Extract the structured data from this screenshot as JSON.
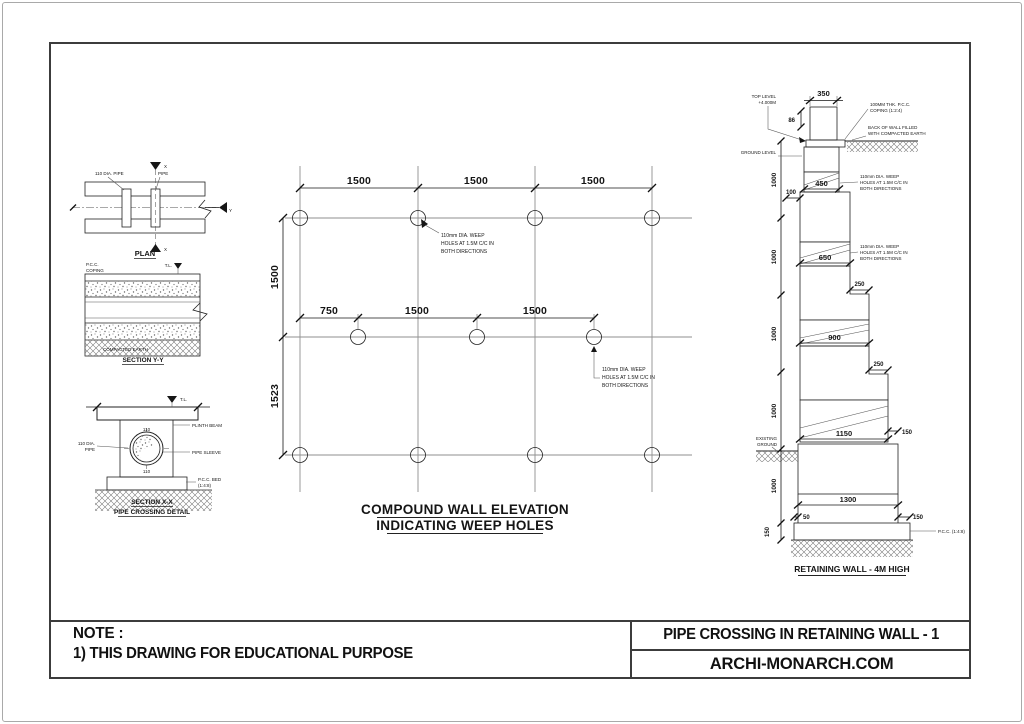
{
  "title_block": {
    "note_label": "NOTE :",
    "note_1": "1) THIS DRAWING FOR EDUCATIONAL PURPOSE",
    "sheet_title": "PIPE CROSSING IN RETAINING WALL - 1",
    "brand": "ARCHI-MONARCH.COM"
  },
  "plan": {
    "title": "PLAN",
    "note_left": "110 DIA. PIPE",
    "note_right": "PIPE",
    "marker_top": "X",
    "marker_bottom": "X",
    "marker_side": "Y"
  },
  "section_yy": {
    "title": "SECTION Y-Y",
    "note_top1": "P.C.C.",
    "note_top2": "COPING",
    "level_label": "T.L.",
    "note_bottom": "COMPACTED EARTH"
  },
  "section_xx": {
    "title": "SECTION X-X",
    "subtitle": "PIPE CROSSING DETAIL",
    "note_left1": "110 DIA.",
    "note_left2": "PIPE",
    "dim_top": "110",
    "dim_bottom": "110",
    "level_label": "T.L.",
    "note_right1": "PLINTH BEAM",
    "note_right2": "PIPE SLEEVE",
    "note_right3": "P.C.C. BED",
    "note_right4": "(1:4:8)"
  },
  "elevation": {
    "title1": "COMPOUND WALL ELEVATION",
    "title2": "INDICATING WEEP HOLES",
    "dim_top": [
      "1500",
      "1500",
      "1500"
    ],
    "dim_mid": [
      "750",
      "1500",
      "1500"
    ],
    "dim_left_top": "1500",
    "dim_left_bottom": "1523",
    "weep1": [
      "110mm DIA. WEEP",
      "HOLES AT 1.5M C/C IN",
      "BOTH DIRECTIONS"
    ],
    "weep2": [
      "110mm DIA. WEEP",
      "HOLES AT 1.5M C/C IN",
      "BOTH DIRECTIONS"
    ]
  },
  "wall": {
    "title": "RETAINING WALL - 4M HIGH",
    "dim_350": "350",
    "dim_86": "86",
    "dim_100": "100",
    "dim_450": "450",
    "dim_650": "650",
    "dim_250a": "250",
    "dim_900": "900",
    "dim_250b": "250",
    "dim_1150": "1150",
    "dim_150a": "150",
    "dim_1300": "1300",
    "dim_50": "50",
    "dim_150b": "150",
    "dim_1000": [
      "1000",
      "1000",
      "1000",
      "1000",
      "1000"
    ],
    "dim_150c": "150",
    "note_coping": [
      "100MM THK. P.C.C.",
      "COPING (1:2:4)"
    ],
    "note_backfill": [
      "BACK OF WALL FILLED",
      "WITH COMPACTED EARTH"
    ],
    "note_top_level": [
      "TOP LEVEL",
      "+4.000M"
    ],
    "note_ground_level": "GROUND LEVEL",
    "note_existing": [
      "EXISTING",
      "GROUND"
    ],
    "note_pcc": "P.C.C. (1:4:8)",
    "weep": [
      "110mm DIA. WEEP",
      "HOLES AT 1.5M C/C IN",
      "BOTH DIRECTIONS"
    ],
    "weep2": [
      "110mm DIA. WEEP",
      "HOLES AT 1.5M C/C IN",
      "BOTH DIRECTIONS"
    ]
  }
}
